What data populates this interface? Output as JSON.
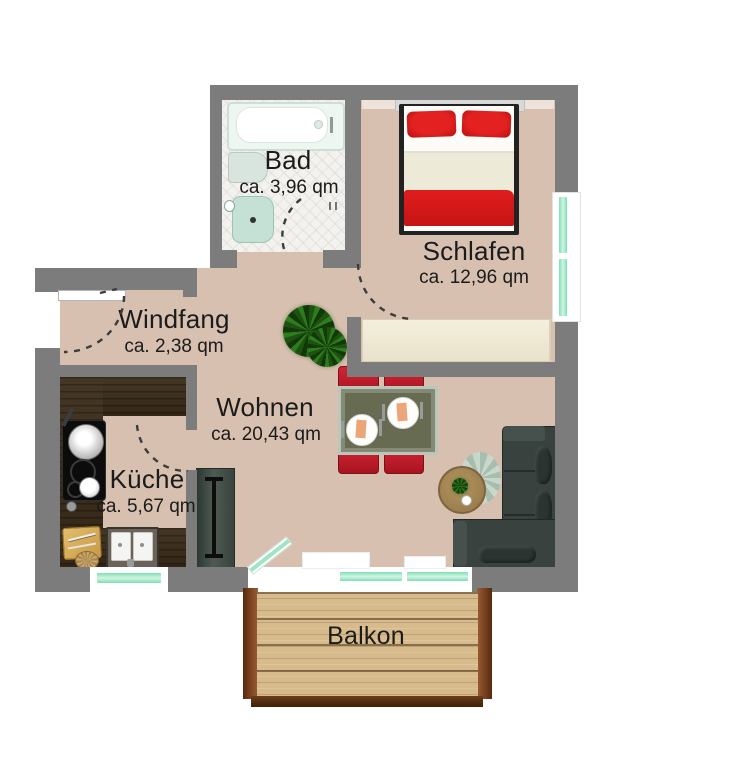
{
  "rooms": {
    "bad": {
      "name": "Bad",
      "area": "ca. 3,96 qm"
    },
    "schlafen": {
      "name": "Schlafen",
      "area": "ca. 12,96 qm"
    },
    "windfang": {
      "name": "Windfang",
      "area": "ca. 2,38 qm"
    },
    "wohnen": {
      "name": "Wohnen",
      "area": "ca. 20,43 qm"
    },
    "kueche": {
      "name": "Küche",
      "area": "ca. 5,67 qm"
    },
    "balkon": {
      "name": "Balkon"
    }
  },
  "colors": {
    "wall": "#7c7c7c",
    "floor": "#d7c0af",
    "bad_floor": "#f3f2ee",
    "counter": "#3a2b18",
    "deck": "#d8bb8c",
    "deck_frame": "#7a4424",
    "glass": "#9ce6c3",
    "bed_red": "#d81a1a",
    "chair_red": "#bf1f2e",
    "sofa": "#39423f",
    "wardrobe": "#efe8d3",
    "cabinet": "#3f4a44",
    "text": "#1b1b1b"
  }
}
